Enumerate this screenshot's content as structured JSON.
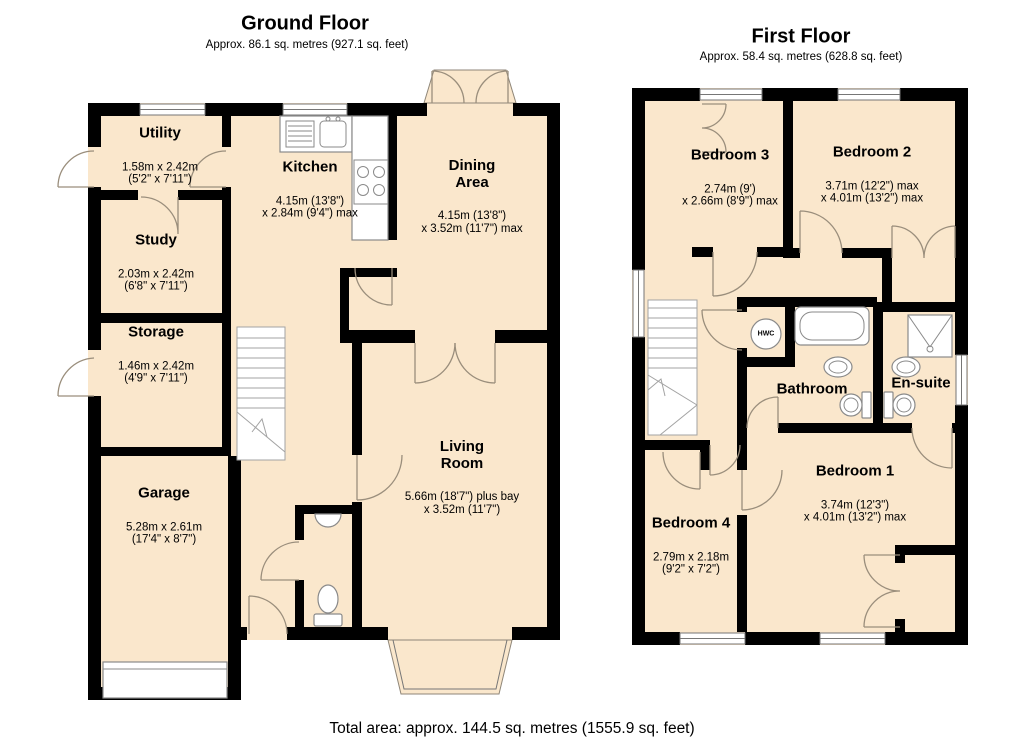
{
  "palette": {
    "room_fill": "#FAE7CC",
    "wall": "#000000",
    "door_line": "#9a8e7c"
  },
  "footer": {
    "total_area": "Total area: approx. 144.5 sq. metres (1555.9 sq. feet)"
  },
  "floors": {
    "ground": {
      "title": "Ground Floor",
      "subtitle": "Approx. 86.1 sq. metres (927.1 sq. feet)",
      "rooms": {
        "utility": {
          "name": "Utility",
          "dims": "1.58m x 2.42m\n(5'2\" x 7'11\")"
        },
        "kitchen": {
          "name": "Kitchen",
          "dims": "4.15m (13'8\")\nx 2.84m (9'4\") max"
        },
        "dining": {
          "name": "Dining\nArea",
          "dims": "4.15m (13'8\")\nx 3.52m (11'7\") max"
        },
        "study": {
          "name": "Study",
          "dims": "2.03m x 2.42m\n(6'8\" x 7'11\")"
        },
        "storage": {
          "name": "Storage",
          "dims": "1.46m x 2.42m\n(4'9\" x 7'11\")"
        },
        "garage": {
          "name": "Garage",
          "dims": "5.28m x 2.61m\n(17'4\" x 8'7\")"
        },
        "living": {
          "name": "Living\nRoom",
          "dims": "5.66m (18'7\") plus bay\nx 3.52m (11'7\")"
        }
      }
    },
    "first": {
      "title": "First Floor",
      "subtitle": "Approx. 58.4 sq. metres (628.8 sq. feet)",
      "rooms": {
        "bedroom3": {
          "name": "Bedroom 3",
          "dims": "2.74m (9')\nx 2.66m (8'9\") max"
        },
        "bedroom2": {
          "name": "Bedroom 2",
          "dims": "3.71m (12'2\") max\nx 4.01m (13'2\") max"
        },
        "bathroom": {
          "name": "Bathroom"
        },
        "ensuite": {
          "name": "En-suite"
        },
        "hwc": {
          "name": "HWC"
        },
        "bedroom1": {
          "name": "Bedroom 1",
          "dims": "3.74m (12'3\")\nx 4.01m (13'2\") max"
        },
        "bedroom4": {
          "name": "Bedroom 4",
          "dims": "2.79m x 2.18m\n(9'2\" x 7'2\")"
        }
      }
    }
  }
}
